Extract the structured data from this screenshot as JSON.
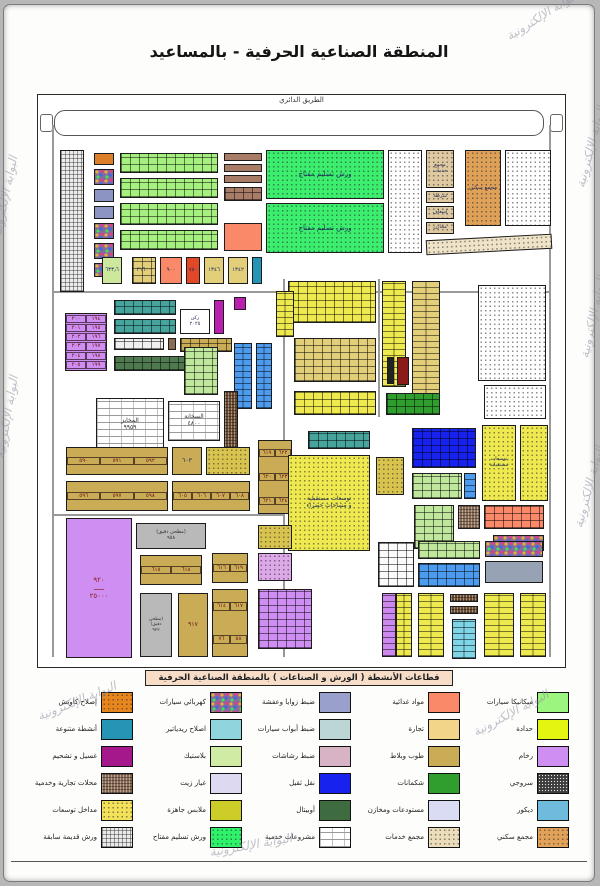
{
  "title": "المنطقة الصناعية الحرفية - بالمساعيد",
  "watermark": {
    "text": "البوابة الإلكترونية"
  },
  "map": {
    "road_label": "الطريق الدائري",
    "blocks": [
      {
        "x": 14,
        "y": 30,
        "w": 1.5,
        "h": 532,
        "p": "line",
        "c": "#999"
      },
      {
        "x": 511,
        "y": 30,
        "w": 1.5,
        "h": 532,
        "p": "line",
        "c": "#999"
      },
      {
        "x": 14,
        "y": 196,
        "w": 498,
        "h": 1.5,
        "p": "line",
        "c": "#999"
      },
      {
        "x": 245,
        "y": 184,
        "w": 1.5,
        "h": 378,
        "p": "line",
        "c": "#999"
      },
      {
        "x": 14,
        "y": 419,
        "w": 232,
        "h": 1.5,
        "p": "line",
        "c": "#999"
      },
      {
        "x": 340,
        "y": 184,
        "w": 1.5,
        "h": 138,
        "p": "line",
        "c": "#999"
      },
      {
        "x": 22,
        "y": 55,
        "w": 24,
        "h": 142,
        "p": "gridp",
        "c": "#ececec"
      },
      {
        "x": 56,
        "y": 58,
        "w": 20,
        "h": 12,
        "p": "solid",
        "c": "#dc7f28"
      },
      {
        "x": 56,
        "y": 74,
        "w": 20,
        "h": 16,
        "p": "mosaic",
        "c": "#8a6a9a"
      },
      {
        "x": 56,
        "y": 94,
        "w": 20,
        "h": 13,
        "p": "solid",
        "c": "#8c94c4"
      },
      {
        "x": 56,
        "y": 111,
        "w": 20,
        "h": 13,
        "p": "solid",
        "c": "#8c94c4"
      },
      {
        "x": 56,
        "y": 128,
        "w": 20,
        "h": 16,
        "p": "mosaic",
        "c": "#8a6a9a"
      },
      {
        "x": 56,
        "y": 148,
        "w": 20,
        "h": 16,
        "p": "mosaic",
        "c": "#8a6a9a"
      },
      {
        "x": 56,
        "y": 168,
        "w": 20,
        "h": 14,
        "p": "mosaic",
        "c": "#8a6a9a"
      },
      {
        "x": 82,
        "y": 58,
        "w": 98,
        "h": 20,
        "p": "cells",
        "c": "#a6f07f"
      },
      {
        "x": 82,
        "y": 83,
        "w": 98,
        "h": 20,
        "p": "cells",
        "c": "#a6f07f"
      },
      {
        "x": 82,
        "y": 108,
        "w": 98,
        "h": 22,
        "p": "cells",
        "c": "#a6f07f"
      },
      {
        "x": 82,
        "y": 135,
        "w": 98,
        "h": 20,
        "p": "cells",
        "c": "#a6f07f"
      },
      {
        "x": 186,
        "y": 58,
        "w": 38,
        "h": 8,
        "p": "solid",
        "c": "#a97c68"
      },
      {
        "x": 186,
        "y": 69,
        "w": 38,
        "h": 8,
        "p": "solid",
        "c": "#a97c68"
      },
      {
        "x": 186,
        "y": 80,
        "w": 38,
        "h": 8,
        "p": "solid",
        "c": "#a97c68"
      },
      {
        "x": 186,
        "y": 92,
        "w": 38,
        "h": 14,
        "p": "cells",
        "c": "#a97c68"
      },
      {
        "x": 186,
        "y": 128,
        "w": 38,
        "h": 28,
        "p": "solid",
        "c": "#f98969"
      },
      {
        "x": 228,
        "y": 55,
        "w": 118,
        "h": 49,
        "p": "dots",
        "c": "#3bee6e",
        "l": "ورش تسليم مفتاح",
        "fs": 7
      },
      {
        "x": 228,
        "y": 108,
        "w": 118,
        "h": 50,
        "p": "dots",
        "c": "#3bee6e",
        "l": "ورش تسليم مفتاح",
        "fs": 7
      },
      {
        "x": 350,
        "y": 55,
        "w": 34,
        "h": 103,
        "p": "dots",
        "c": "#ffffff"
      },
      {
        "x": 388,
        "y": 55,
        "w": 28,
        "h": 38,
        "p": "dots",
        "c": "#dfc9a0",
        "l": "مجمع خدمات",
        "fs": 5
      },
      {
        "x": 388,
        "y": 96,
        "w": 28,
        "h": 12,
        "p": "dots",
        "c": "#dfc9a0",
        "l": "شرطة",
        "fs": 5
      },
      {
        "x": 388,
        "y": 111,
        "w": 28,
        "h": 13,
        "p": "dots",
        "c": "#dfc9a0",
        "l": "إسعاف",
        "fs": 5
      },
      {
        "x": 388,
        "y": 127,
        "w": 28,
        "h": 12,
        "p": "dots",
        "c": "#dfc9a0",
        "l": "مخازن",
        "fs": 5
      },
      {
        "x": 427,
        "y": 55,
        "w": 36,
        "h": 76,
        "p": "dots",
        "c": "#dfa058",
        "l": "مجمع سكني",
        "fs": 5.5
      },
      {
        "x": 467,
        "y": 55,
        "w": 46,
        "h": 76,
        "p": "dots",
        "c": "#ffffff"
      },
      {
        "x": 388,
        "y": 142,
        "w": 126,
        "h": 15,
        "p": "dots",
        "c": "#efe3c8",
        "rot": -3
      },
      {
        "x": 64,
        "y": 162,
        "w": 20,
        "h": 27,
        "p": "solid",
        "c": "#cde89c",
        "l": "٦٣٣٫٦",
        "fs": 5.5
      },
      {
        "x": 94,
        "y": 162,
        "w": 24,
        "h": 27,
        "p": "cells",
        "c": "#e3cf7a",
        "l": "٣١٦٠٠",
        "fs": 5.5
      },
      {
        "x": 122,
        "y": 162,
        "w": 22,
        "h": 27,
        "p": "solid",
        "c": "#f98969",
        "l": "٩٠٠",
        "fs": 5.5
      },
      {
        "x": 148,
        "y": 162,
        "w": 14,
        "h": 27,
        "p": "solid",
        "c": "#e04828",
        "l": "٧٥٠",
        "fs": 5
      },
      {
        "x": 166,
        "y": 162,
        "w": 20,
        "h": 27,
        "p": "solid",
        "c": "#e3cf7a",
        "l": "١٣٤٦",
        "fs": 5.5
      },
      {
        "x": 190,
        "y": 162,
        "w": 20,
        "h": 27,
        "p": "solid",
        "c": "#e3cf7a",
        "l": "١٣٤٢",
        "fs": 5.5
      },
      {
        "x": 214,
        "y": 162,
        "w": 10,
        "h": 27,
        "p": "solid",
        "c": "#2694b4"
      },
      {
        "x": 27,
        "y": 218,
        "w": 42,
        "h": 58,
        "p": "numgrid",
        "c": "#cf8ef2",
        "cols": 2,
        "n": [
          "١٩٤",
          "٢٠٠",
          "١٩٥",
          "٢٠١",
          "١٩٦",
          "٢٠٢",
          "١٩٧",
          "٢٠٣",
          "١٩٨",
          "٢٠٤",
          "١٩٩",
          "٢٠٥"
        ]
      },
      {
        "x": 76,
        "y": 205,
        "w": 62,
        "h": 15,
        "p": "cells",
        "c": "#46a49c"
      },
      {
        "x": 76,
        "y": 224,
        "w": 62,
        "h": 15,
        "p": "cells",
        "c": "#46a49c"
      },
      {
        "x": 76,
        "y": 243,
        "w": 50,
        "h": 12,
        "p": "cells",
        "c": "#f0f0f0"
      },
      {
        "x": 130,
        "y": 243,
        "w": 8,
        "h": 12,
        "p": "solid",
        "c": "#8a6b54"
      },
      {
        "x": 142,
        "y": 243,
        "w": 52,
        "h": 14,
        "p": "cells",
        "c": "#c9ac55"
      },
      {
        "x": 76,
        "y": 261,
        "w": 84,
        "h": 15,
        "p": "cells",
        "c": "#4f7a50"
      },
      {
        "x": 142,
        "y": 214,
        "w": 30,
        "h": 25,
        "p": "solid",
        "c": "#ffffff",
        "l": "ركن|٢٠٢٥",
        "fs": 5
      },
      {
        "x": 176,
        "y": 205,
        "w": 10,
        "h": 34,
        "p": "solid",
        "c": "#bb1fb0"
      },
      {
        "x": 196,
        "y": 202,
        "w": 12,
        "h": 13,
        "p": "solid",
        "c": "#bb1fb0"
      },
      {
        "x": 146,
        "y": 252,
        "w": 34,
        "h": 48,
        "p": "cells",
        "c": "#bfe89c"
      },
      {
        "x": 250,
        "y": 186,
        "w": 88,
        "h": 42,
        "p": "cells",
        "c": "#ede94f"
      },
      {
        "x": 256,
        "y": 243,
        "w": 82,
        "h": 44,
        "p": "cells",
        "c": "#e3cf7a"
      },
      {
        "x": 256,
        "y": 296,
        "w": 82,
        "h": 24,
        "p": "cells",
        "c": "#ede94f"
      },
      {
        "x": 344,
        "y": 186,
        "w": 24,
        "h": 106,
        "p": "cellsv",
        "c": "#ede94f"
      },
      {
        "x": 374,
        "y": 186,
        "w": 28,
        "h": 134,
        "p": "cellsv",
        "c": "#e3cf7a"
      },
      {
        "x": 349,
        "y": 262,
        "w": 7,
        "h": 27,
        "p": "solid",
        "c": "#222222"
      },
      {
        "x": 359,
        "y": 262,
        "w": 12,
        "h": 28,
        "p": "solid",
        "c": "#8b1a1a"
      },
      {
        "x": 348,
        "y": 298,
        "w": 54,
        "h": 22,
        "p": "cells",
        "c": "#2f9e2f"
      },
      {
        "x": 440,
        "y": 190,
        "w": 68,
        "h": 96,
        "p": "dots",
        "c": "#ffffff"
      },
      {
        "x": 446,
        "y": 290,
        "w": 62,
        "h": 34,
        "p": "dots",
        "c": "#ffffff"
      },
      {
        "x": 196,
        "y": 248,
        "w": 18,
        "h": 66,
        "p": "cellsv",
        "c": "#4d9bef"
      },
      {
        "x": 218,
        "y": 248,
        "w": 16,
        "h": 66,
        "p": "cellsv",
        "c": "#4d9bef"
      },
      {
        "x": 238,
        "y": 196,
        "w": 18,
        "h": 46,
        "p": "cellsv",
        "c": "#ede94f"
      },
      {
        "x": 58,
        "y": 303,
        "w": 68,
        "h": 54,
        "p": "brick",
        "c": "#ffffff",
        "l": "المخابز|٩٩٥٩",
        "fs": 6,
        "lc": "#333333"
      },
      {
        "x": 130,
        "y": 306,
        "w": 52,
        "h": 40,
        "p": "brick",
        "c": "#ffffff",
        "l": "السخانة|٤٨٠٠",
        "fs": 6,
        "lc": "#333333"
      },
      {
        "x": 186,
        "y": 296,
        "w": 14,
        "h": 60,
        "p": "weave",
        "c": "#6b4a2e"
      },
      {
        "x": 28,
        "y": 352,
        "w": 102,
        "h": 28,
        "p": "numgrid",
        "c": "#c9ac55",
        "cols": 3,
        "n": [
          "٥٩٢",
          "٥٩١",
          "٥٩٠"
        ]
      },
      {
        "x": 28,
        "y": 386,
        "w": 102,
        "h": 30,
        "p": "numgrid",
        "c": "#c9ac55",
        "cols": 3,
        "n": [
          "٥٩٨",
          "٥٩٧",
          "٥٩٦"
        ]
      },
      {
        "x": 134,
        "y": 352,
        "w": 30,
        "h": 28,
        "p": "solid",
        "c": "#c9ac55",
        "l": "٦٠٣",
        "fs": 6
      },
      {
        "x": 168,
        "y": 352,
        "w": 44,
        "h": 28,
        "p": "dots",
        "c": "#d8c34e"
      },
      {
        "x": 134,
        "y": 386,
        "w": 78,
        "h": 30,
        "p": "numgrid",
        "c": "#c9ac55",
        "cols": 4,
        "n": [
          "٦٠٨",
          "٦٠٧",
          "٦٠٦",
          "٦٠٥"
        ]
      },
      {
        "x": 220,
        "y": 345,
        "w": 34,
        "h": 74,
        "p": "numgrid",
        "c": "#c9ac55",
        "cols": 2,
        "n": [
          "٦٢٢",
          "٦١٩",
          "٦٢٣",
          "٦٢٠",
          "٦٢٤",
          "٦٢١"
        ]
      },
      {
        "x": 270,
        "y": 336,
        "w": 62,
        "h": 18,
        "p": "cells",
        "c": "#46a49c"
      },
      {
        "x": 250,
        "y": 360,
        "w": 82,
        "h": 96,
        "p": "dots",
        "c": "#ede94f",
        "l": "توسعات مستقبلية|و مساحات خضراء",
        "fs": 6
      },
      {
        "x": 338,
        "y": 362,
        "w": 28,
        "h": 38,
        "p": "dots",
        "c": "#d8c34e"
      },
      {
        "x": 374,
        "y": 333,
        "w": 64,
        "h": 40,
        "p": "cells",
        "c": "#1822ef"
      },
      {
        "x": 374,
        "y": 378,
        "w": 50,
        "h": 26,
        "p": "cells",
        "c": "#bfe89c"
      },
      {
        "x": 426,
        "y": 378,
        "w": 12,
        "h": 26,
        "p": "cellsv",
        "c": "#4d9bef"
      },
      {
        "x": 444,
        "y": 330,
        "w": 34,
        "h": 76,
        "p": "dots",
        "c": "#ede94f",
        "l": "توسعات|مستقبلية",
        "fs": 5
      },
      {
        "x": 482,
        "y": 330,
        "w": 28,
        "h": 76,
        "p": "dots",
        "c": "#ede94f"
      },
      {
        "x": 376,
        "y": 410,
        "w": 40,
        "h": 44,
        "p": "cells",
        "c": "#bfe89c"
      },
      {
        "x": 420,
        "y": 410,
        "w": 22,
        "h": 24,
        "p": "weave",
        "c": "#8a6b54"
      },
      {
        "x": 446,
        "y": 410,
        "w": 60,
        "h": 24,
        "p": "cells",
        "c": "#f98969"
      },
      {
        "x": 455,
        "y": 440,
        "w": 51,
        "h": 16,
        "p": "mosaic",
        "c": "#8a6a9a"
      },
      {
        "x": 28,
        "y": 423,
        "w": 66,
        "h": 140,
        "p": "solid",
        "c": "#cf8ef2",
        "l": "٩٢٠|ـــــ|٢٥٠٠٠",
        "fs": 7,
        "lc": "#8b1a1a"
      },
      {
        "x": 98,
        "y": 428,
        "w": 70,
        "h": 26,
        "p": "solid",
        "c": "#b9b9b9",
        "l": "(مطحن دقيق)|٩٥٨",
        "fs": 5,
        "lc": "#333333"
      },
      {
        "x": 102,
        "y": 460,
        "w": 62,
        "h": 30,
        "p": "numgrid",
        "c": "#c9ac55",
        "cols": 2,
        "n": [
          "٦١٨",
          "٦١٥"
        ]
      },
      {
        "x": 102,
        "y": 498,
        "w": 32,
        "h": 64,
        "p": "solid",
        "c": "#b9b9b9",
        "l": "(مطحن|دقيق)|٩٢٢",
        "fs": 4.5,
        "lc": "#333333"
      },
      {
        "x": 140,
        "y": 498,
        "w": 30,
        "h": 64,
        "p": "solid",
        "c": "#c9ac55",
        "l": "٩١٧",
        "fs": 6,
        "lc": "#6b1515"
      },
      {
        "x": 174,
        "y": 458,
        "w": 36,
        "h": 30,
        "p": "numgrid",
        "c": "#c9ac55",
        "cols": 2,
        "n": [
          "٦١٩",
          "٦١٦"
        ]
      },
      {
        "x": 174,
        "y": 494,
        "w": 36,
        "h": 68,
        "p": "numgrid",
        "c": "#c9ac55",
        "cols": 2,
        "n": [
          "٦١٧",
          "٦١٤",
          "٥٨",
          "٧٦"
        ]
      },
      {
        "x": 220,
        "y": 430,
        "w": 34,
        "h": 24,
        "p": "dots",
        "c": "#d8c34e"
      },
      {
        "x": 220,
        "y": 458,
        "w": 34,
        "h": 28,
        "p": "dots",
        "c": "#dca8e8"
      },
      {
        "x": 220,
        "y": 494,
        "w": 54,
        "h": 60,
        "p": "cells",
        "c": "#cf8ef2"
      },
      {
        "x": 340,
        "y": 447,
        "w": 36,
        "h": 45,
        "p": "cells",
        "c": "#fbfbfb"
      },
      {
        "x": 380,
        "y": 446,
        "w": 62,
        "h": 18,
        "p": "cells",
        "c": "#bfe89c"
      },
      {
        "x": 447,
        "y": 446,
        "w": 58,
        "h": 16,
        "p": "mosaic",
        "c": "#8a6a9a"
      },
      {
        "x": 380,
        "y": 468,
        "w": 62,
        "h": 24,
        "p": "cells",
        "c": "#4d9bef"
      },
      {
        "x": 447,
        "y": 466,
        "w": 58,
        "h": 22,
        "p": "solid",
        "c": "#97a3b5"
      },
      {
        "x": 344,
        "y": 498,
        "w": 14,
        "h": 64,
        "p": "cellsv",
        "c": "#cc88ee"
      },
      {
        "x": 358,
        "y": 498,
        "w": 16,
        "h": 64,
        "p": "cellsv",
        "c": "#ede94f"
      },
      {
        "x": 380,
        "y": 498,
        "w": 26,
        "h": 64,
        "p": "cellsv",
        "c": "#ede94f"
      },
      {
        "x": 412,
        "y": 499,
        "w": 28,
        "h": 8,
        "p": "weave",
        "c": "#6b4a2e"
      },
      {
        "x": 412,
        "y": 511,
        "w": 28,
        "h": 8,
        "p": "weave",
        "c": "#6b4a2e"
      },
      {
        "x": 414,
        "y": 524,
        "w": 24,
        "h": 40,
        "p": "cellsv",
        "c": "#7fd4e8"
      },
      {
        "x": 446,
        "y": 498,
        "w": 30,
        "h": 64,
        "p": "cellsv",
        "c": "#ede94f"
      },
      {
        "x": 482,
        "y": 498,
        "w": 26,
        "h": 64,
        "p": "cellsv",
        "c": "#ede94f"
      }
    ]
  },
  "legend": {
    "title": "قطاعات الأنشطة ( الورش و الصناعات ) بالمنطقة الصناعية الحرفية",
    "items": [
      {
        "label": "ميكانيكا سيارات",
        "pattern": "solid",
        "color": "#9cf57e"
      },
      {
        "label": "مواد غدائية",
        "pattern": "solid",
        "color": "#f98969"
      },
      {
        "label": "ضبط زوايا وعفشة",
        "pattern": "solid",
        "color": "#99a0cc"
      },
      {
        "label": "كهربائي سيارات",
        "pattern": "mosaic",
        "color": "#8a6a9a"
      },
      {
        "label": "إصلاح كاوتش",
        "pattern": "dots",
        "color": "#e8861e"
      },
      {
        "label": "حدادة",
        "pattern": "solid",
        "color": "#e4f511"
      },
      {
        "label": "تجارة",
        "pattern": "solid",
        "color": "#f2d589"
      },
      {
        "label": "ضبط أبواب سيارات",
        "pattern": "solid",
        "color": "#bcd6d6"
      },
      {
        "label": "اصلاح ريدياتير",
        "pattern": "solid",
        "color": "#90d4de"
      },
      {
        "label": "أنشطة متنوعة",
        "pattern": "solid",
        "color": "#2694b4"
      },
      {
        "label": "رخام",
        "pattern": "solid",
        "color": "#cf8ef2"
      },
      {
        "label": "طوب وبلاط",
        "pattern": "solid",
        "color": "#c9ac55"
      },
      {
        "label": "ضبط رشاشات",
        "pattern": "solid",
        "color": "#d8b3c6"
      },
      {
        "label": "بلاستيك",
        "pattern": "solid",
        "color": "#cfeba4"
      },
      {
        "label": "غسيل و تشحيم",
        "pattern": "solid",
        "color": "#a5188c"
      },
      {
        "label": "سروجي",
        "pattern": "hatchdark",
        "color": "#3d3d3d"
      },
      {
        "label": "شكمانات",
        "pattern": "solid",
        "color": "#2f9e2f"
      },
      {
        "label": "نقل ثقيل",
        "pattern": "solid",
        "color": "#1822ef"
      },
      {
        "label": "غيار زيت",
        "pattern": "solid",
        "color": "#dcd9f0"
      },
      {
        "label": "محلات تجارية وخدمية",
        "pattern": "weave",
        "color": "#8a6b54"
      },
      {
        "label": "ديكور",
        "pattern": "solid",
        "color": "#6fbbdd"
      },
      {
        "label": "مستودعات ومخازن",
        "pattern": "solid",
        "color": "#d9dcf2"
      },
      {
        "label": "أوبيتال",
        "pattern": "solid",
        "color": "#3f6b41"
      },
      {
        "label": "ملابس جاهزة",
        "pattern": "solid",
        "color": "#cdcd29"
      },
      {
        "label": "مداخل توسعات",
        "pattern": "dots",
        "color": "#f2e159"
      },
      {
        "label": "مجمع سكني",
        "pattern": "dots",
        "color": "#e2a159"
      },
      {
        "label": "مجمع خدمات",
        "pattern": "dots",
        "color": "#ebdcba"
      },
      {
        "label": "مشروعات خدمية",
        "pattern": "brick",
        "color": "#ffffff"
      },
      {
        "label": "ورش تسليم مفتاح",
        "pattern": "dots",
        "color": "#2ef26a"
      },
      {
        "label": "ورش قديمة سابقة",
        "pattern": "gridp",
        "color": "#ebebeb"
      }
    ]
  }
}
